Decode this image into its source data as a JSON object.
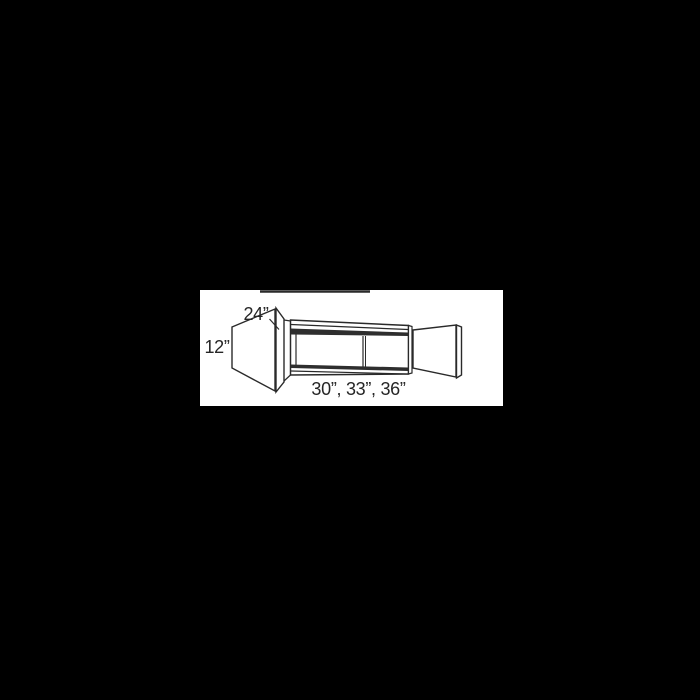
{
  "window": {
    "background_color": "#000000",
    "panel_background": "#ffffff"
  },
  "diagram": {
    "type": "cabinet-line-drawing",
    "description": "Perspective line drawing of a wall cabinet with both doors open, top of drawing clipped by image edge",
    "line_color": "#2a2a2a",
    "shadow_band_color": "#2e2e2e",
    "text_color": "#262626",
    "labels": {
      "depth": "24”",
      "height": "12”",
      "widths": "30”, 33”, 36”"
    }
  }
}
